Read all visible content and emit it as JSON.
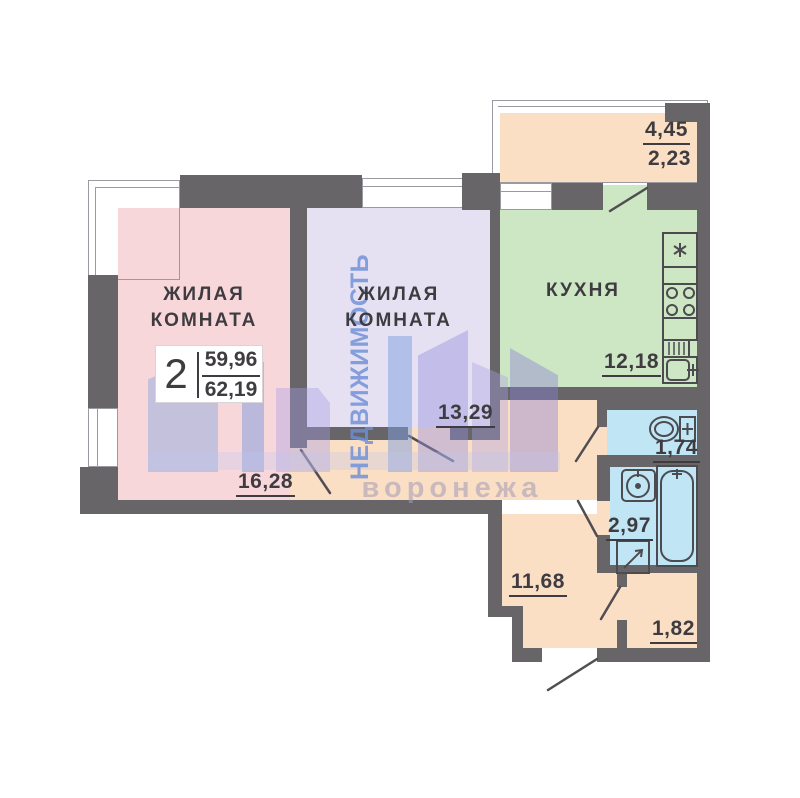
{
  "colors": {
    "wall": "#676568",
    "thin_line": "#9b9aa0",
    "ink": "#3e3c40",
    "pink": "#f8d7db",
    "lavender": "#e6e1f2",
    "green": "#cde6c3",
    "orange": "#fbdfc5",
    "blue": "#c0e6f5",
    "wm_blue": "#7da2e2",
    "wm_purple": "#a99ee0"
  },
  "summary": {
    "room_count": "2",
    "area_living": "59,96",
    "area_total": "62,19"
  },
  "rooms": {
    "living1": {
      "name": "ЖИЛАЯ\nКОМНАТА",
      "area": "16,28"
    },
    "living2": {
      "name": "ЖИЛАЯ\nКОМНАТА",
      "area": "13,29"
    },
    "kitchen": {
      "name": "КУХНЯ",
      "area": "12,18"
    },
    "hallway": {
      "area": "11,68"
    },
    "wc": {
      "area": "1,74"
    },
    "bathroom": {
      "area": "2,97"
    },
    "storage": {
      "area": "1,82"
    },
    "balcony": {
      "area_full": "4,45",
      "area_counted": "2,23"
    }
  },
  "watermark": {
    "vertical_text": "НЕДВИЖИМОСТЬ",
    "city_text": "воронежа"
  }
}
